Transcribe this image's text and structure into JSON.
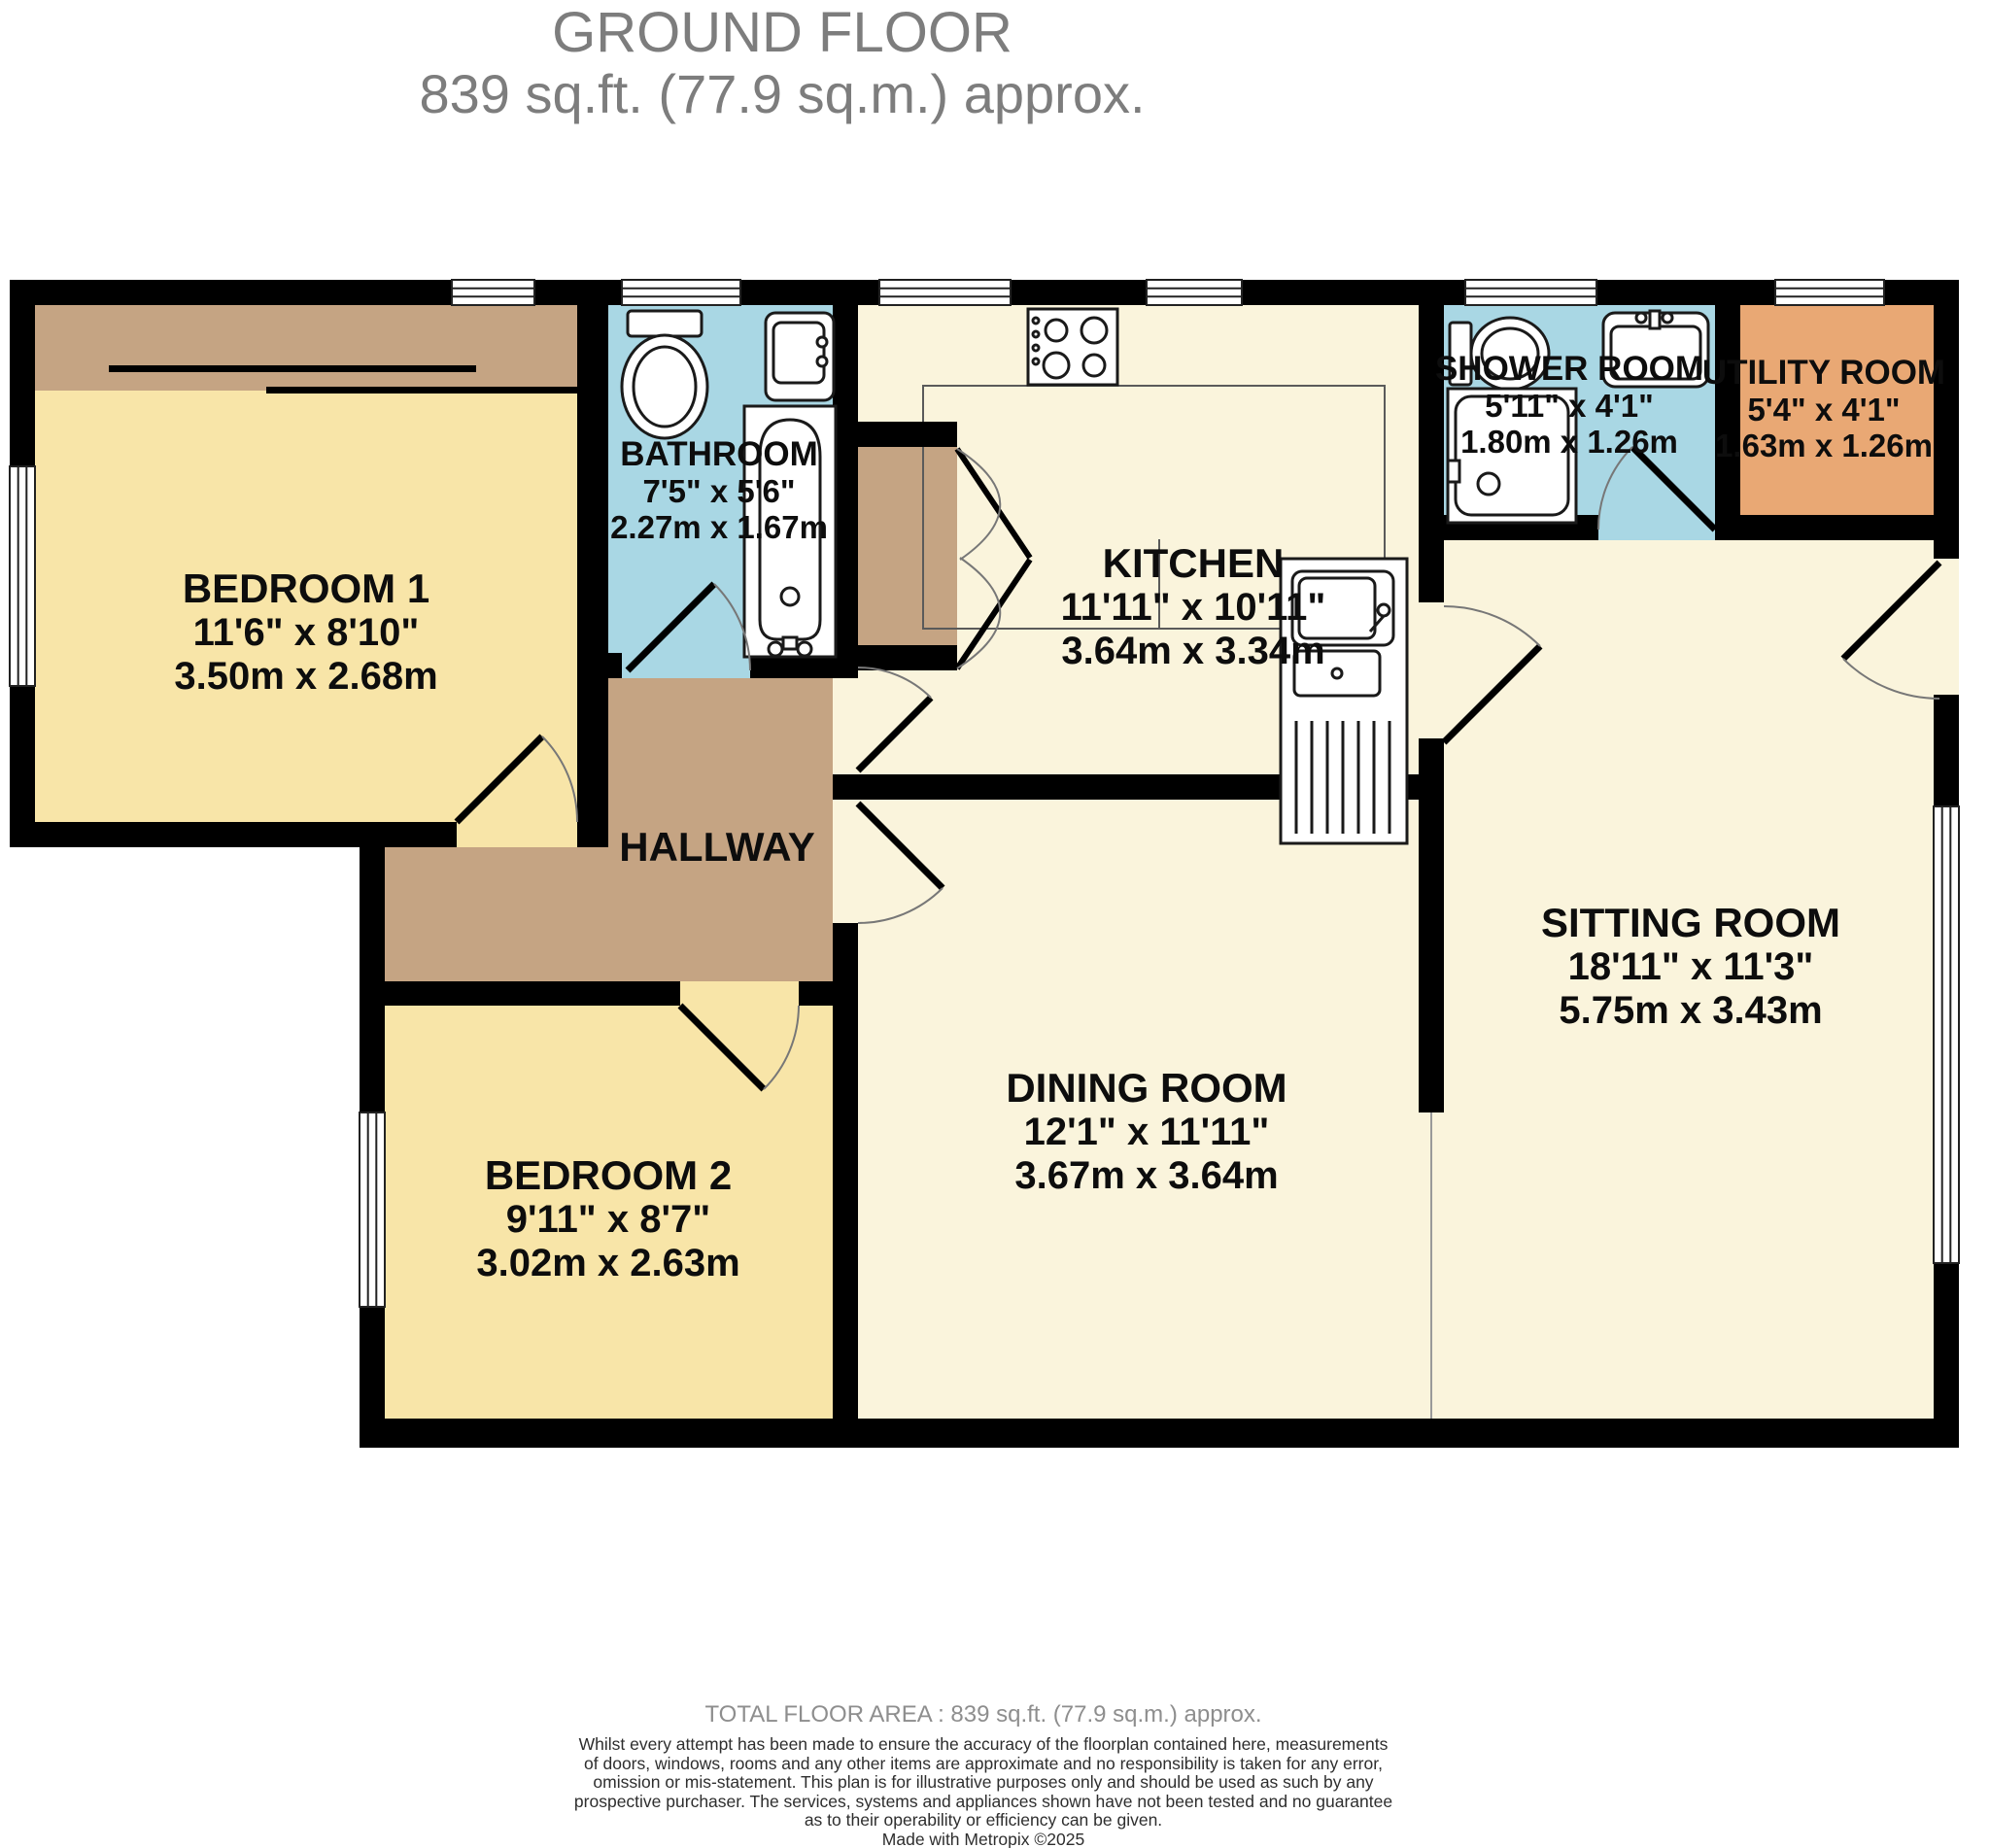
{
  "title": {
    "line1": "GROUND FLOOR",
    "line2": "839 sq.ft. (77.9 sq.m.) approx."
  },
  "rooms": [
    {
      "id": "bedroom-1",
      "name": "BEDROOM 1",
      "imperial": "11'6\"  x 8'10\"",
      "metric": "3.50m  x 2.68m",
      "color": "#f8e5a8"
    },
    {
      "id": "bathroom",
      "name": "BATHROOM",
      "imperial": "7'5\"  x 5'6\"",
      "metric": "2.27m  x 1.67m",
      "color": "#a9d7e4"
    },
    {
      "id": "kitchen",
      "name": "KITCHEN",
      "imperial": "11'11\"  x 10'11\"",
      "metric": "3.64m  x 3.34m",
      "color": "#faf4dc"
    },
    {
      "id": "shower-room",
      "name": "SHOWER ROOM",
      "imperial": "5'11\"  x 4'1\"",
      "metric": "1.80m  x 1.26m",
      "color": "#a9d7e4"
    },
    {
      "id": "utility-room",
      "name": "UTILITY ROOM",
      "imperial": "5'4\"  x 4'1\"",
      "metric": "1.63m  x 1.26m",
      "color": "#e9a874"
    },
    {
      "id": "sitting-room",
      "name": "SITTING ROOM",
      "imperial": "18'11\"  x 11'3\"",
      "metric": "5.75m  x 3.43m",
      "color": "#faf4dc"
    },
    {
      "id": "dining-room",
      "name": "DINING ROOM",
      "imperial": "12'1\"  x 11'11\"",
      "metric": "3.67m  x 3.64m",
      "color": "#faf4dc"
    },
    {
      "id": "bedroom-2",
      "name": "BEDROOM 2",
      "imperial": "9'11\"  x 8'7\"",
      "metric": "3.02m  x 2.63m",
      "color": "#f8e5a8"
    }
  ],
  "hallway": {
    "name": "HALLWAY",
    "color": "#c5a483"
  },
  "footer": {
    "total": "TOTAL FLOOR AREA : 839 sq.ft. (77.9 sq.m.) approx.",
    "disclaimer_lines": [
      "Whilst every attempt has been made to ensure the accuracy of the floorplan contained here, measurements",
      "of doors, windows, rooms and any other items are approximate and no responsibility is taken for any error,",
      "omission or mis-statement. This plan is for illustrative purposes only and should be used as such by any",
      "prospective purchaser. The services, systems and appliances shown have not been tested and no guarantee",
      "as to their operability or efficiency can be given.",
      "Made with Metropix ©2025"
    ]
  },
  "palette": {
    "wall": "#000000",
    "bedroom_yellow": "#f8e5a8",
    "living_cream": "#faf4dc",
    "wet_room_blue": "#a9d7e4",
    "hallway_brown": "#c5a483",
    "utility_orange": "#e9a874",
    "title_gray": "#7d7d7d",
    "footer_gray": "#8e8e8e"
  }
}
